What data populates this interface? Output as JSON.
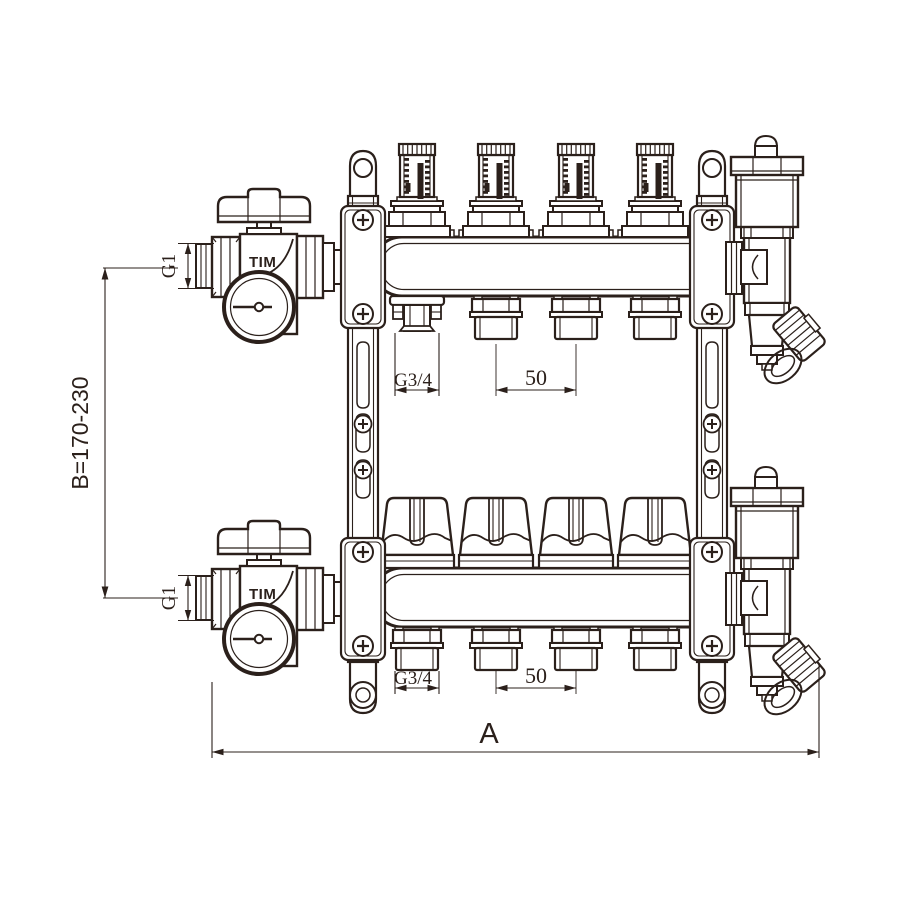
{
  "drawing": {
    "subject": "heating manifold technical drawing, 4 circuits with flow meters",
    "brand": "TIM",
    "circuits": 4,
    "labels": {
      "height_range": "B=170-230",
      "overall_width": "A",
      "inlet_thread": "G1",
      "outlet_thread": "G3/4",
      "outlet_spacing": "50"
    },
    "colors": {
      "line": "#2b201b",
      "background": "#ffffff"
    }
  }
}
